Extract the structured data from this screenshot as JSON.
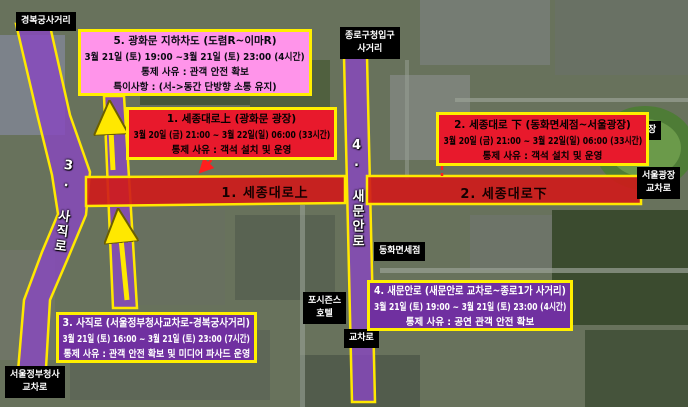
{
  "colors": {
    "notice_pink": "#ff94ea",
    "notice_red": "#e8192c",
    "notice_purple": "#7030a0",
    "border_yellow": "#ffef00",
    "closed_road_red": "#d01a1a",
    "closed_road_purple": "#8748c0",
    "label_bg": "#000000",
    "label_text": "#ffffff"
  },
  "notices": {
    "underpass": {
      "title": "5. 광화문 지하차도 (도렴R~이마R)",
      "period": "3월 21일 (토) 19:00 ~3월 21일 (토) 23:00 (4시간)",
      "reason": "통제 사유 : 관객 안전 확보",
      "note": "특이사항 : (서->동간 단방향 소통 유지)"
    },
    "sejong_upper": {
      "title": "1. 세종대로上 (광화문 광장)",
      "period": "3월 20일 (금) 21:00 ~ 3월 22일(일) 06:00 (33시간)",
      "reason": "통제 사유 : 객석 설치 및 운영"
    },
    "sejong_lower": {
      "title": "2. 세종대로 下 (동화면세점~서울광장)",
      "period": "3월 20일 (금) 21:00 ~ 3월 22일(일) 06:00 (33시간)",
      "reason": "통제 사유 : 객석 설치 및 운영"
    },
    "sajik": {
      "title": "3. 사직로 (서울정부청사교차로-경복궁사거리)",
      "period": "3월 21일 (토) 16:00 ~ 3월 21일 (토) 23:00 (7시간)",
      "reason": "통제 사유 : 관객 안전 확보 및 미디어 파사드 운영"
    },
    "saemunan": {
      "title": "4. 새문안로 (새문안로 교차로~종로1가 사거리)",
      "period": "3월 21일 (토) 19:00 ~ 3월 21일 (토) 23:00 (4시간)",
      "reason": "통제 사유 : 공연 관객 안전 확보"
    }
  },
  "road_labels": {
    "sejong_upper": "1. 세종대로上",
    "sejong_lower": "2. 세종대로下",
    "sajik": "3. 사직로",
    "saemunan": "4. 새문안로"
  },
  "place_labels": {
    "gyeongbokgung": "경복궁사거리",
    "jongno_gucheong": [
      "종로구청입구",
      "사거리"
    ],
    "seoul_plaza": "서울광장",
    "seoul_plaza_crossing": [
      "서울광장",
      "교차로"
    ],
    "donghwa_duty_free": "동화면세점",
    "four_seasons_hotel": [
      "포시즌스",
      "호텔"
    ],
    "crossing": "교차로",
    "gov_complex_crossing": [
      "서울정부청사",
      "교차로"
    ]
  }
}
